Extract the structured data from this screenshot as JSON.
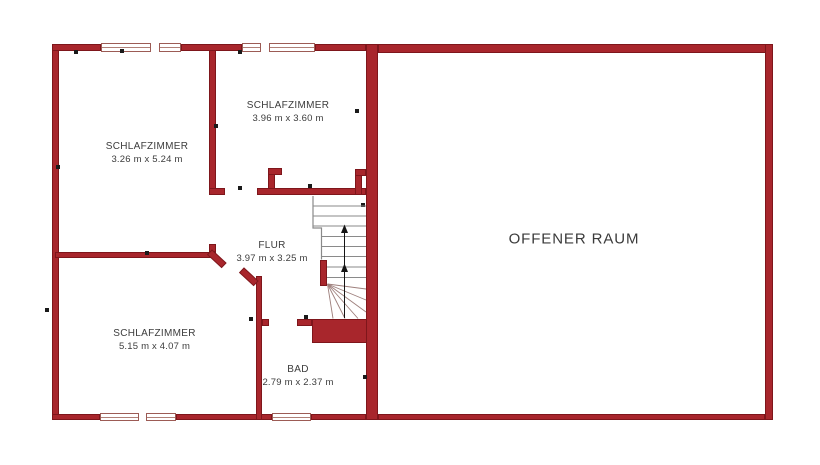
{
  "plan": {
    "type": "floor-plan",
    "language": "de",
    "rooms": [
      {
        "id": "schlafzimmer-top-left",
        "name": "SCHLAFZIMMER",
        "dimensions": "3.26 m x 5.24 m"
      },
      {
        "id": "schlafzimmer-top-middle",
        "name": "SCHLAFZIMMER",
        "dimensions": "3.96 m x 3.60 m"
      },
      {
        "id": "schlafzimmer-bottom-left",
        "name": "SCHLAFZIMMER",
        "dimensions": "5.15 m x 4.07 m"
      },
      {
        "id": "flur",
        "name": "FLUR",
        "dimensions": "3.97 m x 3.25 m"
      },
      {
        "id": "bad",
        "name": "BAD",
        "dimensions": "2.79 m x 2.37 m"
      },
      {
        "id": "offener-raum",
        "name": "OFFENER RAUM",
        "dimensions": ""
      }
    ],
    "stairs": {
      "direction": "up",
      "arrow_icon": "up-arrow",
      "flights": 2,
      "has_winders": true
    },
    "counts": {
      "windows_top": 2,
      "windows_bottom": 2,
      "door_openings": 4
    },
    "colors": {
      "wall_fill": "#A8262C",
      "wall_border": "#7E161B",
      "window_frame": "#9c5b55",
      "stair_line": "#8a8a8a",
      "winder_line": "#9e7f7c",
      "arrow": "#151515",
      "text": "#3c3c3c",
      "background": "#ffffff"
    }
  }
}
